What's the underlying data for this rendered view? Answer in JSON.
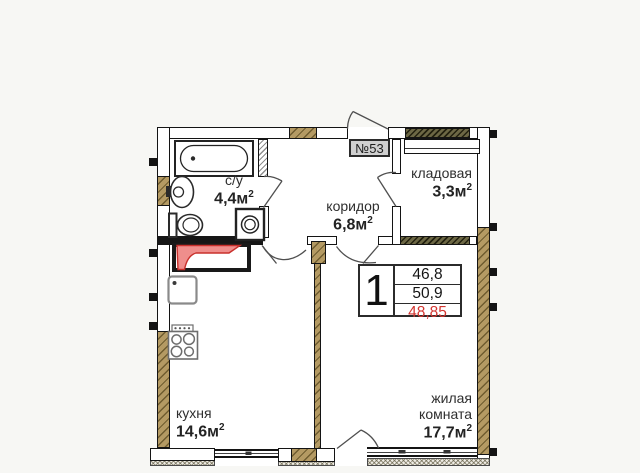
{
  "unit": {
    "badge": "№53"
  },
  "rooms": {
    "bathroom": {
      "name": "с/у",
      "area": "4,4м",
      "area_sup": "2"
    },
    "corridor": {
      "name": "коридор",
      "area": "6,8м",
      "area_sup": "2"
    },
    "storage": {
      "name": "кладовая",
      "area": "3,3м",
      "area_sup": "2"
    },
    "kitchen": {
      "name": "кухня",
      "area": "14,6м",
      "area_sup": "2"
    },
    "living_room": {
      "name_line1": "жилая",
      "name_line2": "комната",
      "area": "17,7м",
      "area_sup": "2"
    }
  },
  "info_box": {
    "rooms_count": "1",
    "values": [
      "46,8",
      "50,9",
      "48,85"
    ],
    "highlighted_value_index": 2,
    "highlight_color": "#d33530"
  },
  "fixtures": [
    "bathtub",
    "washbasin",
    "toilet",
    "washing-machine",
    "kitchen-sink",
    "stove",
    "ventilation-shaft"
  ],
  "colors": {
    "wall_hatch_tan": "#b49a63",
    "partition_hatch_dark": "#6d6845",
    "vent_highlight": "#ef8e8c",
    "accent_red": "#d33530",
    "badge_bg": "#cfcfcf"
  }
}
